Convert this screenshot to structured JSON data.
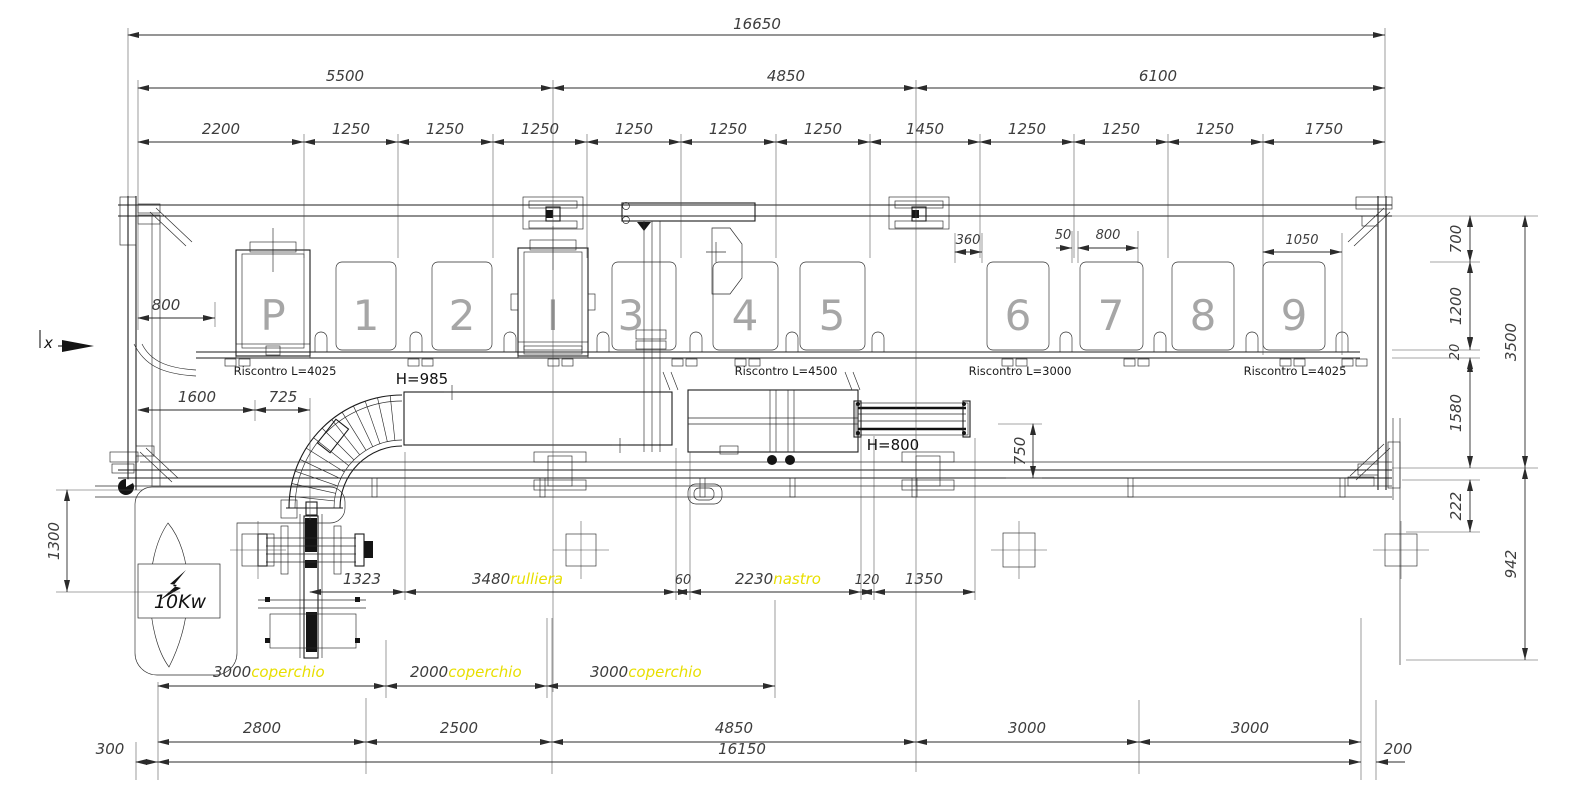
{
  "stations": [
    "P",
    "1",
    "2",
    "I",
    "3",
    "4",
    "5",
    "6",
    "7",
    "8",
    "9"
  ],
  "dimensions": {
    "overall": "16650",
    "bays": [
      "5500",
      "4850",
      "6100"
    ],
    "pitches": [
      "2200",
      "1250",
      "1250",
      "1250",
      "1250",
      "1250",
      "1250",
      "1450",
      "1250",
      "1250",
      "1250",
      "1750"
    ],
    "d360": "360",
    "d50": "50",
    "d800_top": "800",
    "d1050": "1050",
    "d800_left": "800",
    "d1600": "1600",
    "d725": "725",
    "d1300": "1300",
    "d700": "700",
    "d1200": "1200",
    "d20": "20",
    "d1580": "1580",
    "d3500": "3500",
    "d222": "222",
    "d942": "942",
    "d750": "750",
    "d1323": "1323",
    "d3480": "3480",
    "d60": "60",
    "d2230": "2230",
    "d120": "120",
    "d1350": "1350",
    "covers": [
      "3000",
      "2000",
      "3000"
    ],
    "bottom": [
      "2800",
      "2500",
      "4850",
      "3000",
      "3000"
    ],
    "d300": "300",
    "d16150": "16150",
    "d200": "200"
  },
  "notes": {
    "rulliera": "rulliera",
    "nastro": "nastro",
    "coperchio": "coperchio"
  },
  "labels": {
    "riscontro1": "Riscontro L=4025",
    "riscontro2": "Riscontro L=4500",
    "riscontro3": "Riscontro L=3000",
    "riscontro4": "Riscontro L=4025",
    "h_curve": "H=985",
    "h_belt": "H=800",
    "power": "10Kw",
    "axis": "x"
  },
  "colors": {
    "line": "#1c1c1c",
    "dim_text": "#3d3d3d",
    "station_text": "#a6a6a6",
    "highlight": "#e8df00",
    "background": "#ffffff"
  }
}
